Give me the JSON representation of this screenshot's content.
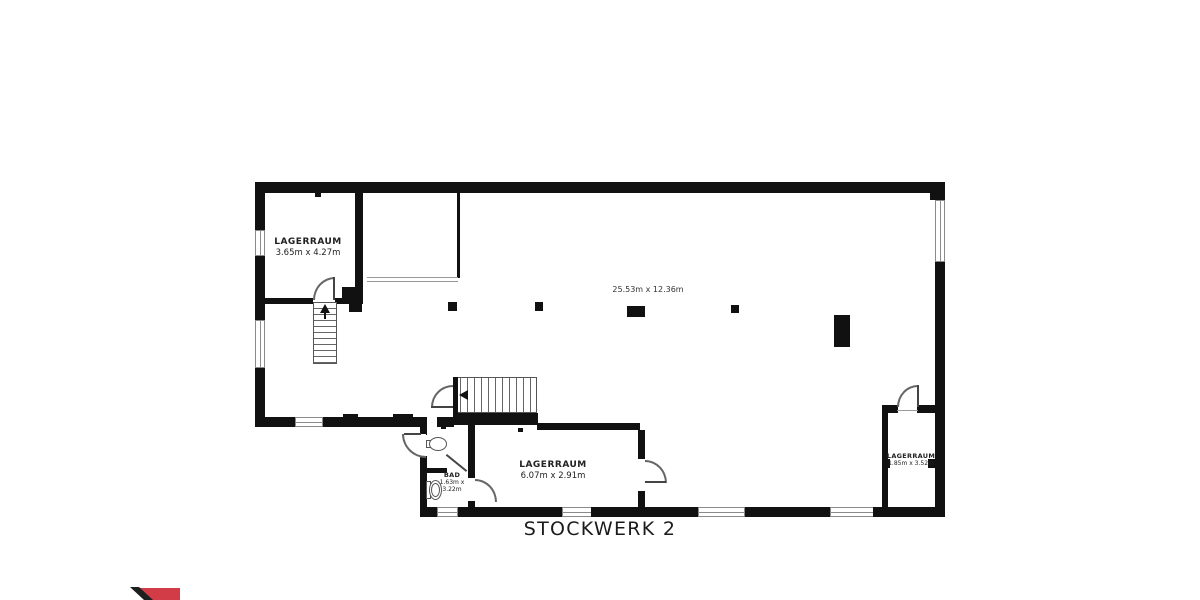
{
  "title": "STOCKWERK 2",
  "rooms": {
    "storage_top_left": {
      "name": "LAGERRAUM",
      "dims": "3.65m x 4.27m"
    },
    "main_area": {
      "dims": "25.53m x 12.36m"
    },
    "storage_bottom": {
      "name": "LAGERRAUM",
      "dims": "6.07m x 2.91m"
    },
    "bathroom": {
      "name": "BAD",
      "dims_line1": "1.63m x",
      "dims_line2": "3.22m"
    },
    "storage_right": {
      "name": "LAGERRAUM",
      "dims": "1.85m x 3.52m"
    }
  },
  "colors": {
    "wall": "#111111",
    "logo_red": "#d13c46",
    "logo_stripe": "#1f1f1f"
  }
}
